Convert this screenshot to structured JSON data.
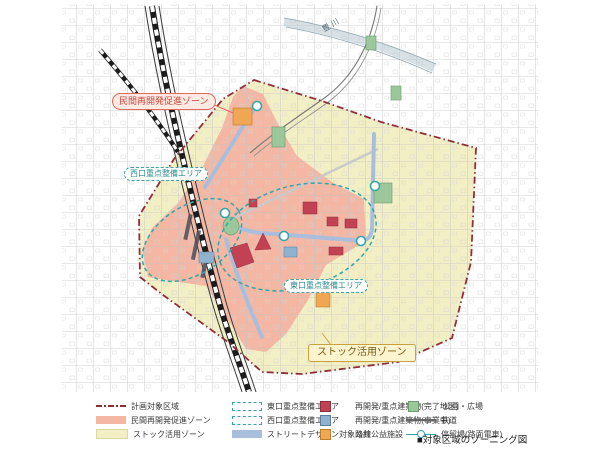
{
  "figure": {
    "caption": "■対象区域のゾーニング図"
  },
  "map": {
    "river_label": "豊川",
    "callouts": {
      "private_redev": "民間再開発促進ゾーン",
      "west_exit": "西口重点整備エリア",
      "east_exit": "東口重点整備エリア",
      "stock_use": "ストック活用ゾーン"
    }
  },
  "legend": {
    "items": [
      {
        "label": "計画対象区域",
        "swatch": "dashdot-line"
      },
      {
        "label": "民間再開発促進ゾーン",
        "swatch": "pink-fill"
      },
      {
        "label": "ストック活用ゾーン",
        "swatch": "yellow-fill"
      },
      {
        "label": "東口重点整備エリア",
        "swatch": "teal-dashed-box"
      },
      {
        "label": "西口重点整備エリア",
        "swatch": "teal-dashed-box"
      },
      {
        "label": "ストリートデザイン対象路線",
        "swatch": "blue-fill"
      },
      {
        "label": "再開発/重点建築物(完了地区)",
        "swatch": "red-square"
      },
      {
        "label": "再開発/重点建築物(事業中)",
        "swatch": "blue-square"
      },
      {
        "label": "公共公益施設",
        "swatch": "orange-square"
      },
      {
        "label": "公園・広場",
        "swatch": "green-square"
      },
      {
        "label": "鉄道",
        "swatch": "rail-line"
      },
      {
        "label": "停留場(路面電車)",
        "swatch": "tram-stop"
      }
    ]
  },
  "colors": {
    "boundary": "#8e2f38",
    "zone-pink": "#f3b7a3",
    "zone-yellow": "#f3efc5",
    "area-teal": "#35a5a8",
    "route-blue": "#a9bedd",
    "redev-done": "#c24253",
    "redev-active": "#8fb2cf",
    "public-facility": "#f0a653",
    "park": "#9bc79a",
    "railway": "#666666"
  }
}
